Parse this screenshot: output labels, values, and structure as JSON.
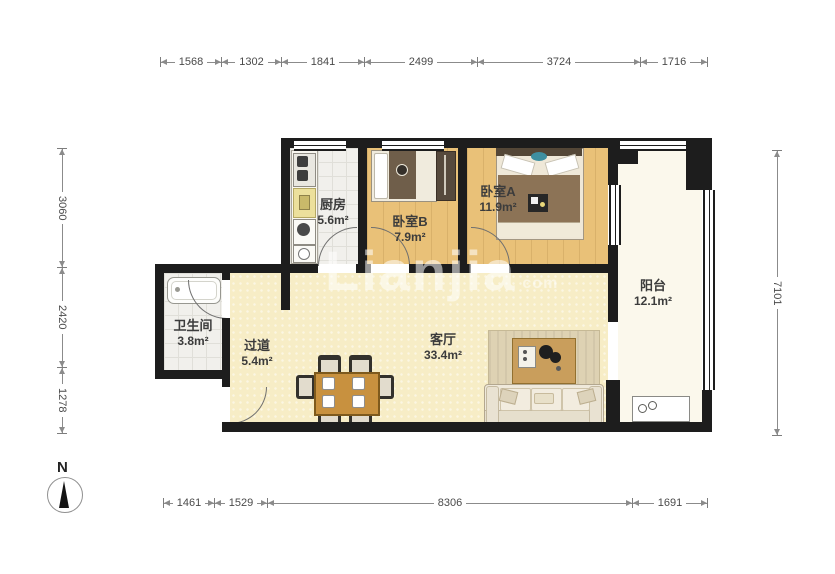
{
  "rooms": [
    {
      "name": "厨房",
      "area": "5.6m²"
    },
    {
      "name": "卧室B",
      "area": "7.9m²"
    },
    {
      "name": "卧室A",
      "area": "11.9m²"
    },
    {
      "name": "阳台",
      "area": "12.1m²"
    },
    {
      "name": "卫生间",
      "area": "3.8m²"
    },
    {
      "name": "过道",
      "area": "5.4m²"
    },
    {
      "name": "客厅",
      "area": "33.4m²"
    }
  ],
  "dimensions": {
    "top": [
      "1568",
      "1302",
      "1841",
      "2499",
      "3724",
      "1716"
    ],
    "bottom": [
      "1461",
      "1529",
      "8306",
      "1691"
    ],
    "left": [
      "3060",
      "2420",
      "1278"
    ],
    "right": [
      "7101"
    ]
  },
  "compass": {
    "label": "N"
  },
  "watermark": {
    "text": "Lianjia",
    "suffix": "com"
  },
  "colors": {
    "wall": "#1d1d1d",
    "wood_floor": "#e9c178",
    "living_floor": "#f7edc6",
    "tile_floor": "#f1f0ec",
    "balcony_floor": "#fbf8ec",
    "dim_line": "#8b8b8b",
    "label_text": "#3c3c3c"
  }
}
